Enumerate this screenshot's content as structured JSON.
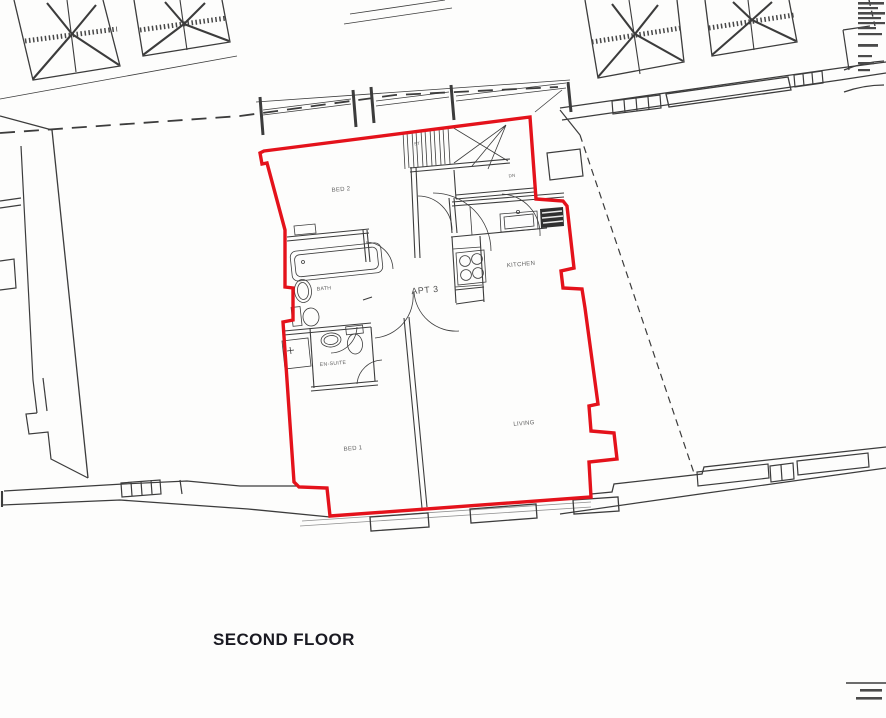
{
  "drawing": {
    "title": "SECOND FLOOR",
    "unit_label": "APT 3",
    "rooms": [
      {
        "label": "BED 2"
      },
      {
        "label": "BATH"
      },
      {
        "label": "EN-SUITE"
      },
      {
        "label": "BED 1"
      },
      {
        "label": "KITCHEN"
      },
      {
        "label": "LIVING"
      }
    ],
    "stairs": {
      "down": "DN",
      "store": "ST"
    },
    "colors": {
      "unit_outline": "#e4121b",
      "linework": "#3c3c3c",
      "label_text": "#5f5f5f",
      "title_text": "#1a1a22",
      "background": "#fdfdfc"
    }
  }
}
